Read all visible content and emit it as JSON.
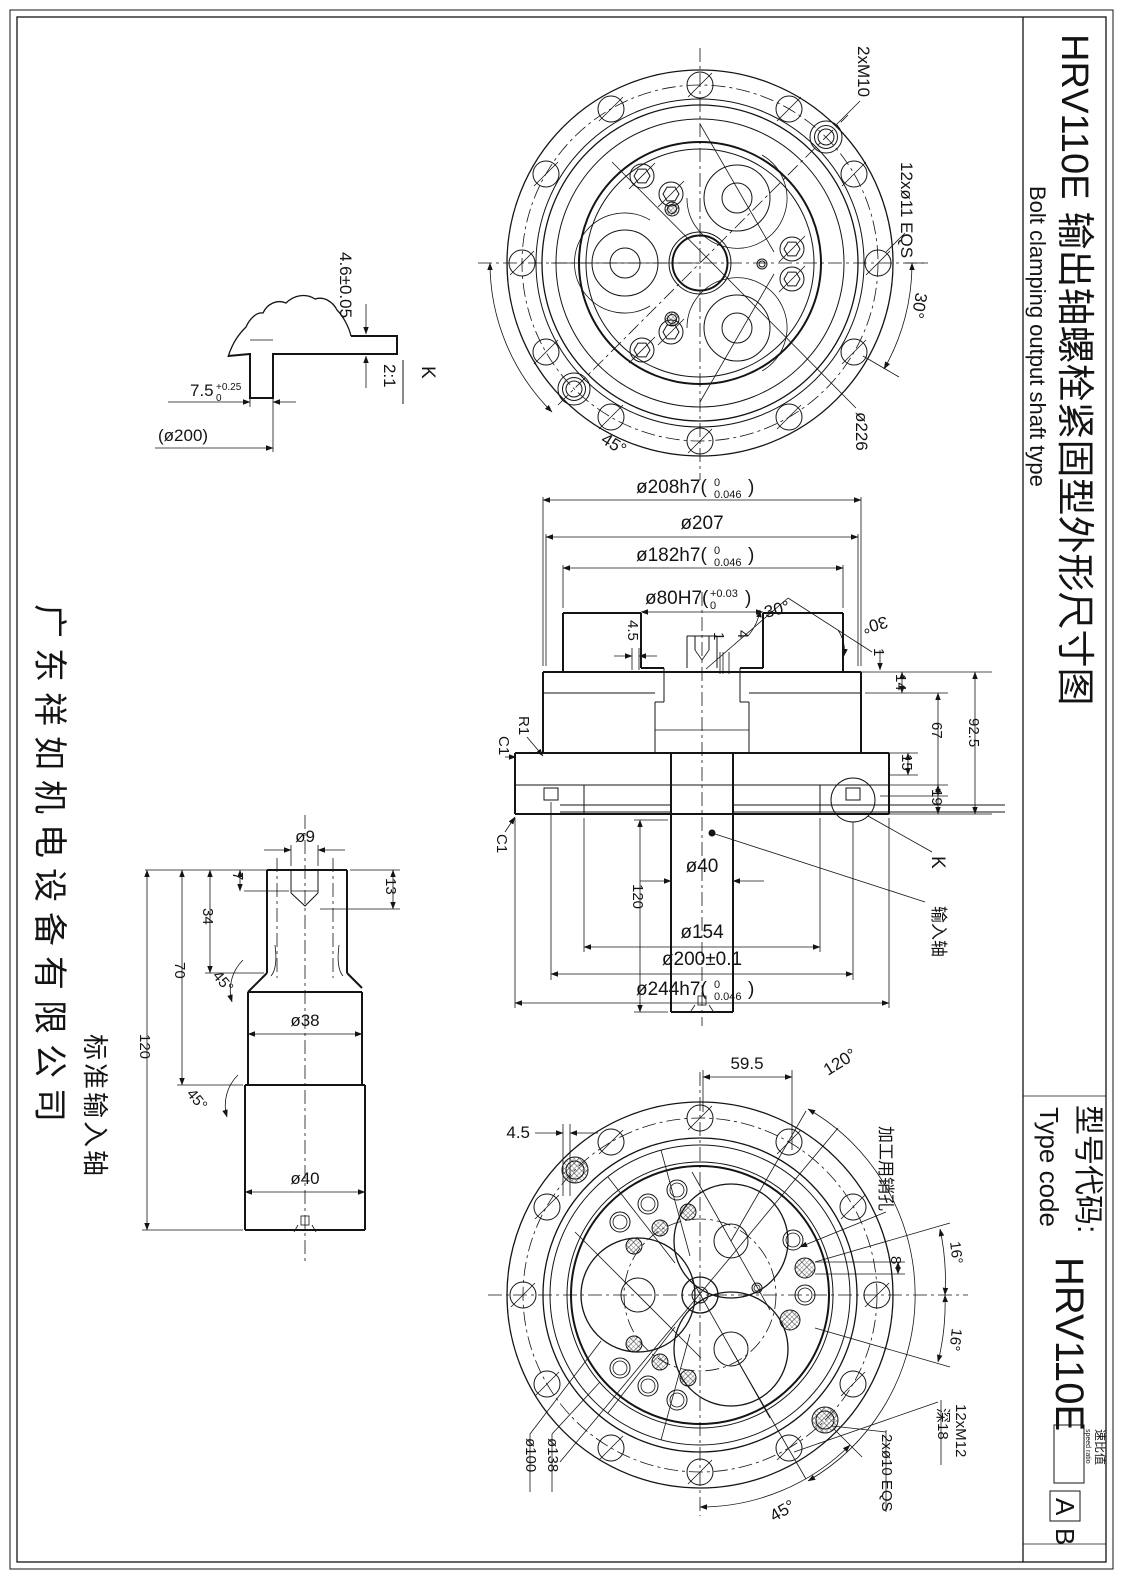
{
  "frame": {
    "title_model": "HRV110E",
    "title_cn": "输出轴螺栓紧固型外形尺寸图",
    "title_en": "Bolt clamping output shaft type",
    "company": "广东祥如机电设备有限公司",
    "type_code_cn": "型号代码:",
    "type_code_en": "Type code",
    "type_code_model": "HRV110E",
    "speed_ratio_cn": "速比值",
    "speed_ratio_en": "speed ratio",
    "option_a": "A",
    "option_b": "B"
  },
  "detail_k": {
    "thickness": "4.6±0.05",
    "slot_main": "7.5",
    "slot_tol_up": "+0.25",
    "slot_tol_dn": "0",
    "ref_dia": "(ø200)",
    "view_label": "K",
    "view_scale": "2:1"
  },
  "top_view": {
    "m10": "2xM10",
    "holes": "12xø11 EQS",
    "angle30": "30°",
    "bolt_circle": "ø226",
    "angle45": "45°"
  },
  "section_view": {
    "d208_main": "ø208h7(",
    "d208_up": "0",
    "d208_dn": "0.046",
    "d208_close": ")",
    "d207": "ø207",
    "d182_main": "ø182h7(",
    "d182_up": "0",
    "d182_dn": "0.046",
    "d182_close": ")",
    "d80_main": "ø80H7(",
    "d80_up": "+0.03",
    "d80_dn": "0",
    "d80_close": ")",
    "angle30a": "30°",
    "angle30b": "30°",
    "d4_5": "4.5",
    "d1a": "1",
    "d4": "4",
    "d1b": "1",
    "d14": "14",
    "d67": "67",
    "d92_5": "92.5",
    "d15": "15",
    "d19": "19",
    "r1": "R1",
    "c1a": "C1",
    "c1b": "C1",
    "len120": "120",
    "d40": "ø40",
    "d154": "ø154",
    "d200": "ø200±0.1",
    "d244_main": "ø244h7(",
    "d244_up": "0",
    "d244_dn": "0.046",
    "d244_close": ")",
    "k_ref": "K",
    "input_shaft": "输入轴"
  },
  "bottom_view": {
    "d59_5": "59.5",
    "d4_5": "4.5",
    "angle120": "120°",
    "pin_hole": "加工用销孔",
    "d8": "8",
    "angle16a": "16°",
    "angle16b": "16°",
    "m12": "12xM12",
    "m12_depth": "深18",
    "d10": "2xø10 EQS",
    "d138": "ø138",
    "d100": "ø100",
    "angle45": "45°"
  },
  "input_shaft": {
    "caption": "标准输入轴",
    "d9": "ø9",
    "d7": "7",
    "d13": "13",
    "d34": "34",
    "d70": "70",
    "len120": "120",
    "angle45a": "45°",
    "angle45b": "45°",
    "d38": "ø38",
    "d40": "ø40"
  }
}
